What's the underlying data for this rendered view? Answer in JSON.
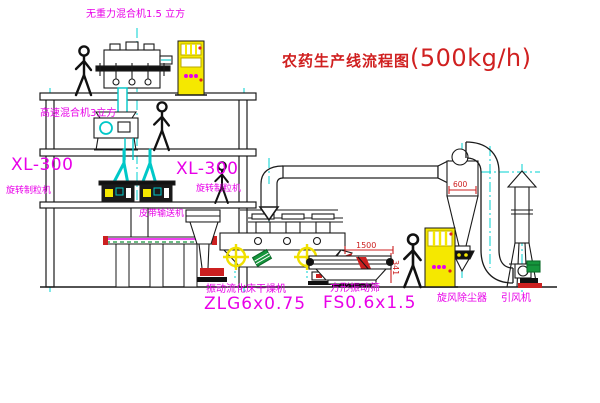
{
  "title": {
    "name": "农药生产线流程图",
    "capacity": "(500kg/h)"
  },
  "labels": {
    "gravity_mixer": "无重力混合机1.5 立方",
    "high_speed_mixer": "高速混合机3立方",
    "granulator_left_model": "XL-300",
    "granulator_left_name": "旋转制粒机",
    "granulator_right_model": "XL-300",
    "granulator_right_name": "旋转制粒机",
    "belt_conveyor": "皮带输送机",
    "dryer_name": "振动流化床干燥机",
    "dryer_model": "ZLG6x0.75",
    "sieve_name": "方形振动筛",
    "sieve_model": "FS0.6x1.5",
    "cyclone": "旋风除尘器",
    "fan": "引风机"
  },
  "dimensions": {
    "sieve_length": "1500",
    "sieve_height": "341",
    "cyclone_diameter": "600"
  },
  "colors": {
    "label_magenta": "#e800e8",
    "title_red": "#d02020",
    "dimension_red": "#cc2020",
    "centerline_cyan": "#00d0d0",
    "cabinet_yellow": "#f5e800",
    "machine_green": "#15953c",
    "line_black": "#1a1a1a"
  }
}
